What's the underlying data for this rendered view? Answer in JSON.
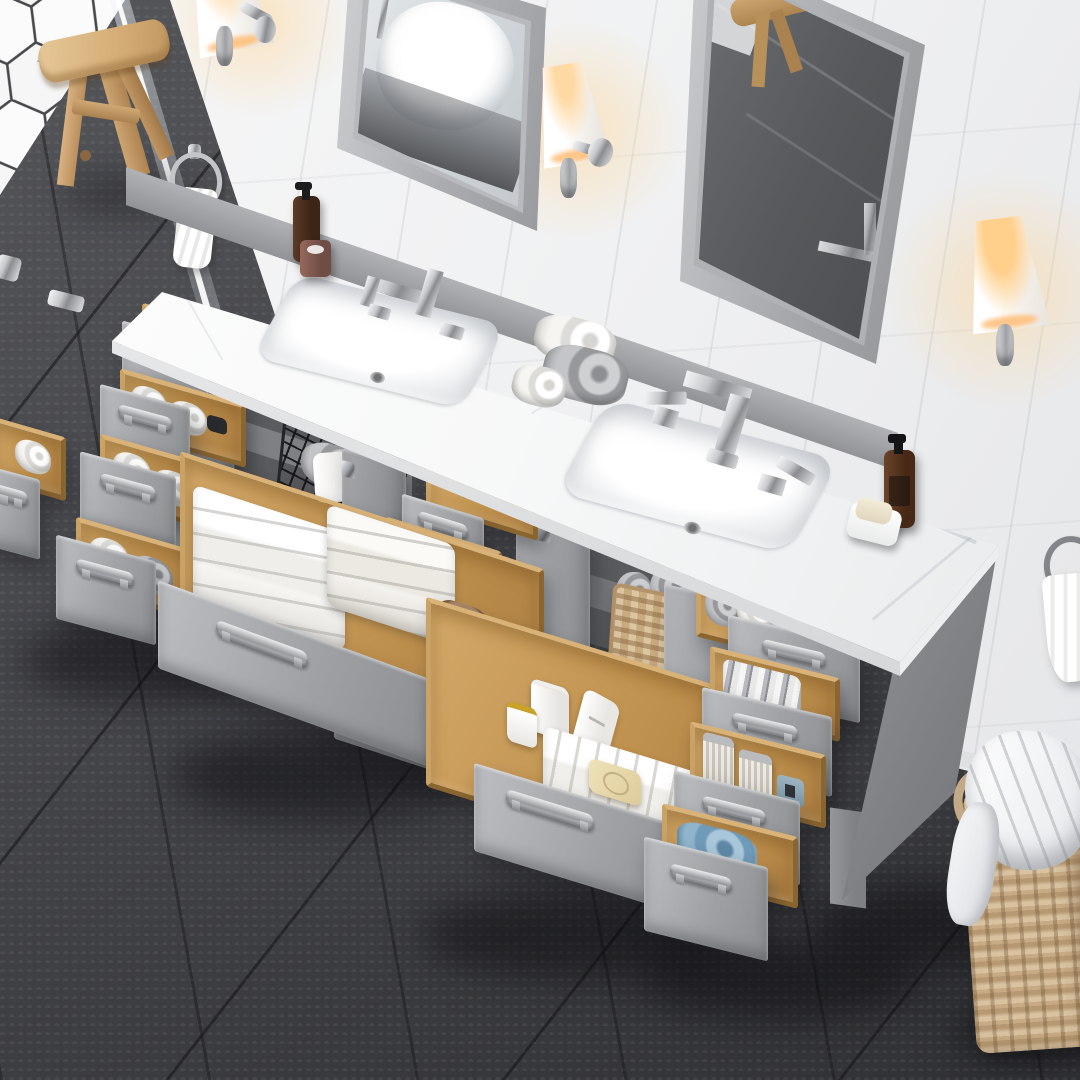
{
  "meta": {
    "description": "Overhead product photo of an 84-inch gray double-sink bathroom vanity with white marble top; every drawer and door is open showing organized towels and toiletries; two gray-framed mirrors, three lit sconces, hexagon-tile shower corner, dark gray tile floor, wicker laundry hamper.",
    "image_type": "product-photo-render"
  },
  "palette": {
    "wall": "#f1f2f3",
    "wall-joint": "#d8d9dc",
    "floor-dark": "#3c3d40",
    "floor-mid": "#47484c",
    "grout": "#2c2d30",
    "cabinet": "#9fa1a4",
    "cabinet-dark": "#7c7e81",
    "interior": "#535457",
    "wood": "#d3a868",
    "wood-dark": "#a87c40",
    "marble": "#f8f9f9",
    "chrome-hi": "#f4f5f6",
    "chrome-lo": "#85878b",
    "towel-white": "#f4f3f0",
    "towel-gray": "#9a9b9e",
    "towel-brown": "#8a6a4f",
    "towel-blue": "#7fa9c6",
    "amber": "#54341f",
    "wicker": "#c8ab84",
    "glow": "#ffd9a4"
  },
  "objects": {
    "wall": {
      "label": "White large-format tiled wall"
    },
    "hexWall": {
      "label": "White hexagon tile shower wall"
    },
    "floor": {
      "label": "Dark gray large tile floor"
    },
    "glassPanel": {
      "label": "Frameless glass shower panel"
    },
    "stool": {
      "label": "Light wood bath stool"
    },
    "mirrorLeft": {
      "label": "Gray framed mirror reflecting freestanding bathtub"
    },
    "mirrorRight": {
      "label": "Gray framed mirror reflecting stool and tile floor"
    },
    "sconce1": {
      "label": "Wall sconce with white shade (top left, cropped)"
    },
    "sconce2": {
      "label": "Lit wall sconce between mirrors"
    },
    "sconce3": {
      "label": "Lit wall sconce on right wall"
    },
    "towelRingLeft": {
      "label": "Chrome towel ring with white hand towel"
    },
    "towelRingRight": {
      "label": "Towel ring with white hand towel, right wall"
    },
    "counter": {
      "label": "White carrara-style marble countertop"
    },
    "sinkLeft": {
      "label": "Left rectangular undermount sink"
    },
    "sinkRight": {
      "label": "Right rectangular undermount sink"
    },
    "faucetLeft": {
      "label": "Left brushed-nickel widespread faucet"
    },
    "faucetRight": {
      "label": "Right brushed-nickel widespread faucet"
    },
    "counterTowels": {
      "label": "Rolled white and gray towels on counter"
    },
    "soapBottleLeft": {
      "label": "Brown pump soap bottle and candle cup"
    },
    "soapBottleRight": {
      "label": "Amber soap pump bottle"
    },
    "soapDish": {
      "label": "White soap dish with soap bar"
    },
    "vanity": {
      "label": "Gray double vanity cabinet, all drawers open"
    },
    "doorLeftCabinet": {
      "label": "Open cabinet doors, left sink cabinet"
    },
    "doorCenterCabinet": {
      "label": "Open cabinet doors, right sink cabinet"
    },
    "wireBasket": {
      "label": "Black wire basket with rolled towel"
    },
    "amberBottles": {
      "label": "Amber apothecary bottles inside cabinet"
    },
    "wickerBasket": {
      "label": "Wicker basket with rolled gray towels"
    },
    "drawer": {
      "label": "Open drawer with oak box and towels"
    },
    "bigDrawerLeft": {
      "label": "Wide drawer with folded white and brown towels"
    },
    "bigDrawerCenter": {
      "label": "Wide drawer with jars, lotion, towel and soap"
    },
    "sidePanel": {
      "label": "Vanity right side panel and legs"
    },
    "hamper": {
      "label": "Wicker laundry hamper with white liner"
    }
  }
}
